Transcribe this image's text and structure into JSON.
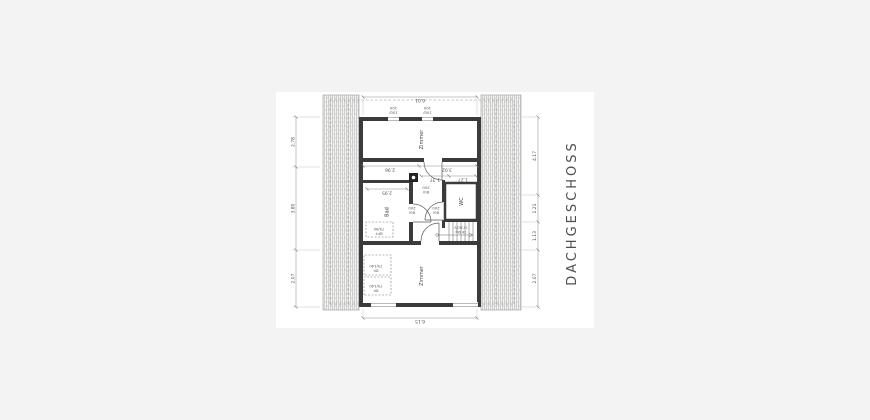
{
  "title": {
    "label": "DACHGESCHOSS"
  },
  "rooms": {
    "zimmer_1": "Zimmer",
    "zimmer_2": "Zimmer",
    "bad": "Bad",
    "wc": "WC"
  },
  "dims": {
    "outer_left": "6.15",
    "outer_right": "6.01",
    "top": [
      "2.07",
      "3.80",
      "2.78"
    ],
    "bottom": [
      "2.07",
      "1.13",
      "1.21",
      "4.17"
    ],
    "mid": [
      "2.96",
      "3.02"
    ],
    "bad": "2.95",
    "corridor": [
      "1.37",
      "1.27"
    ]
  },
  "windows": {
    "w1": [
      "100/",
      "100"
    ],
    "w2": [
      "100/",
      "100"
    ]
  },
  "doors": {
    "d1": [
      "80/",
      "200"
    ],
    "d2": [
      "80/",
      "200"
    ],
    "d3": [
      "80/",
      "200"
    ]
  },
  "skylights": {
    "bad": [
      "DFF",
      "75/90"
    ],
    "df1": [
      "DF",
      "75/140"
    ],
    "df2": [
      "DF",
      "75/140"
    ]
  },
  "stairs": {
    "label": [
      "16 Stg",
      "17,6/29"
    ]
  },
  "colors": {
    "viewer_bg": "#f3f3f4",
    "page_bg": "#ffffff",
    "wall": "#3b3b3b",
    "dim_line": "#8a8a8a",
    "hatch_line": "#adadad"
  }
}
